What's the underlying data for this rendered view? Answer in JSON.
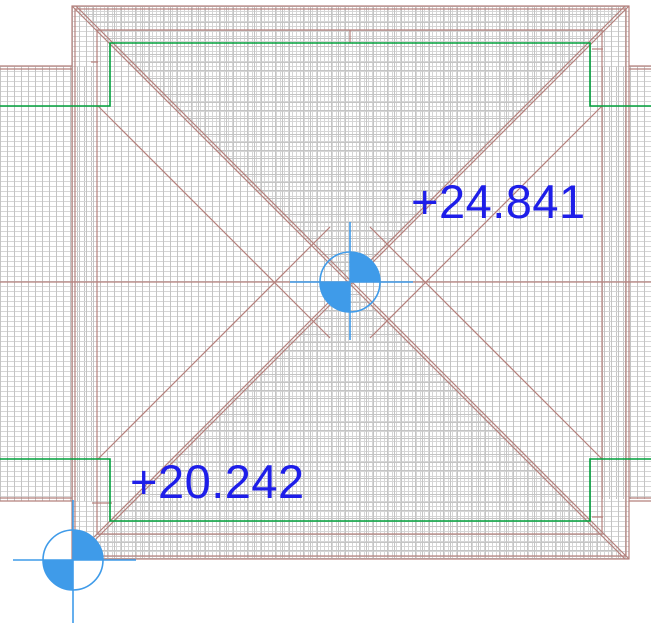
{
  "drawing": {
    "type_label": "roof-plan-view",
    "annotations": {
      "upper_spot": {
        "elevation_label": "+24.841"
      },
      "lower_spot": {
        "elevation_label": "+20.242"
      }
    },
    "icons": [
      "spot-elevation-marker-icon",
      "crosshair-icon"
    ]
  },
  "colors": {
    "line_red": "#b5807c",
    "line_green": "#00a03c",
    "hatch_strong": "#c4c4c4",
    "hatch_light": "#d6d6d6",
    "label_blue": "#1e1ee9",
    "symbol_blue": "#3f9be9",
    "bg": "#ffffff"
  }
}
